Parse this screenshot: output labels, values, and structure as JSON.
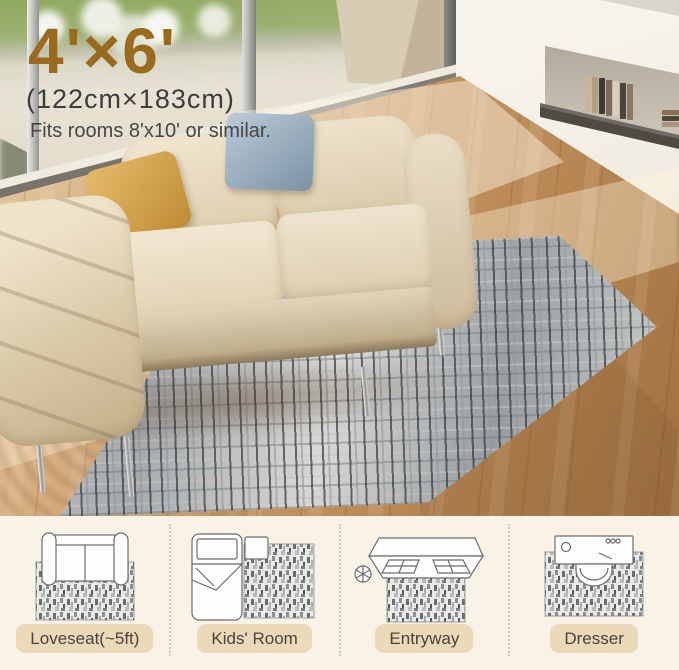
{
  "overlay": {
    "size_feet": "4'×6'",
    "size_cm": "(122cm×183cm)",
    "fits_note": "Fits rooms 8'x10' or similar."
  },
  "palette": {
    "accent_brown": "#9a6a1d",
    "overlay_text": "#3d3d3d",
    "strip_bg": "#f9f2e7",
    "label_pill_bg": "#ecd9ba",
    "label_text": "#4a443a",
    "rug_light": "#e3e3e1",
    "rug_mid": "#9ea2a5",
    "rug_dark": "#53575b",
    "floor_light": "#e5cda6",
    "floor_dark": "#9f6f3f",
    "sofa_beige": "#e9ddc3",
    "pillow_gold": "#cfa14e",
    "pillow_blue": "#8ba0b1",
    "grass_green": "#90aa60"
  },
  "usage_panels": [
    {
      "label": "Loveseat(~5ft)",
      "icon": "loveseat-top-view"
    },
    {
      "label": "Kids' Room",
      "icon": "kids-room-bed"
    },
    {
      "label": "Entryway",
      "icon": "entry-door"
    },
    {
      "label": "Dresser",
      "icon": "dresser-stool"
    }
  ]
}
